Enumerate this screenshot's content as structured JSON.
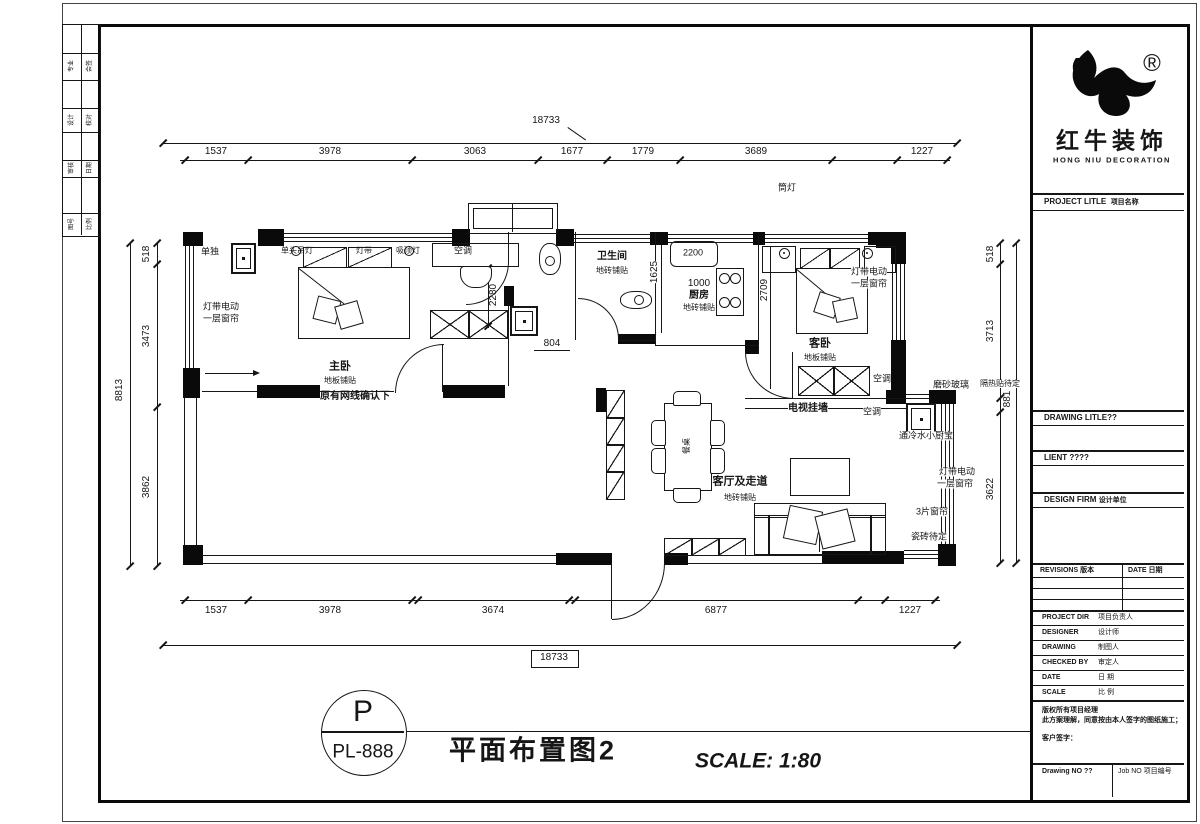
{
  "plan": {
    "dims": {
      "top_total": "18733",
      "top": [
        "1537",
        "3978",
        "3063",
        "1677",
        "1779",
        "3689",
        "1227"
      ],
      "bottom_total": "18733",
      "bottom": [
        "1537",
        "3978",
        "3674",
        "6877",
        "1227"
      ],
      "left_total": "8813",
      "left": [
        "518",
        "3473",
        "3862"
      ],
      "right": [
        "518",
        "3713",
        "881",
        "3622"
      ],
      "master_depth": "2280",
      "hall_width": "804",
      "bath_width": "1625",
      "sink": "2200",
      "kitchen_width": "1000",
      "guest_depth": "2709"
    },
    "notes": {
      "downlight": "筒灯",
      "insulation": "隔热贴待定",
      "solo": "单独",
      "lamp_pendant": "单头吊灯",
      "lamp_strip": "灯带",
      "lamp_ceiling": "吸顶灯",
      "net_note": "原有网线确认下",
      "curtain_l1": "灯带电动",
      "curtain_l2": "一层窗帘",
      "frosted": "磨砂玻璃",
      "heater": "通冷水小厨宝",
      "curtain3": "3片窗帘",
      "tile_tbd": "瓷砖待定",
      "tv_wall": "电视挂墙",
      "ac": "空调",
      "table": "餐桌"
    },
    "rooms": {
      "master": {
        "name": "主卧",
        "floor": "地板铺贴"
      },
      "bath": {
        "name": "卫生间",
        "floor": "地砖铺贴"
      },
      "kitchen": {
        "name": "厨房",
        "floor": "地砖铺贴"
      },
      "guest": {
        "name": "客卧",
        "floor": "地板铺贴"
      },
      "living": {
        "name": "客厅及走道",
        "floor": "地砖铺贴"
      }
    }
  },
  "stamp": {
    "letter": "P",
    "code": "PL-888"
  },
  "titlebar": {
    "drawing_title": "平面布置图2",
    "scale": "SCALE: 1:80"
  },
  "title_block": {
    "brand_cn": "红牛装饰",
    "brand_en": "HONG NIU DECORATION",
    "registered": "®",
    "project_title": "PROJECT LITLE",
    "project_title_cn": "项目名称",
    "drawing_title_label": "DRAWING LITLE??",
    "client_label": "LIENT ????",
    "design_firm": "DESIGN FIRM",
    "design_firm_cn": "设计单位",
    "revisions": "REVISIONS 版本",
    "date_col": "DATE 日期",
    "rows": [
      {
        "en": "PROJECT DIR",
        "cn": "项目负责人"
      },
      {
        "en": "DESIGNER",
        "cn": "设计师"
      },
      {
        "en": "DRAWING",
        "cn": "制图人"
      },
      {
        "en": "CHECKED BY",
        "cn": "审定人"
      },
      {
        "en": "DATE",
        "cn": "日 期"
      },
      {
        "en": "SCALE",
        "cn": "比 例"
      }
    ],
    "note1": "版权所有项目经理",
    "note2": "此方案理解，同意按由本人签字的图纸施工；",
    "note3": "客户签字：",
    "drawing_no": "Drawing NO ??",
    "job_no": "Job NO 项目编号"
  },
  "edge_strip": {
    "cells": [
      [
        "专业",
        "会签"
      ],
      [
        "设计",
        "校对"
      ],
      [
        "审核",
        "日期"
      ],
      [
        "图号",
        "比例"
      ]
    ]
  }
}
